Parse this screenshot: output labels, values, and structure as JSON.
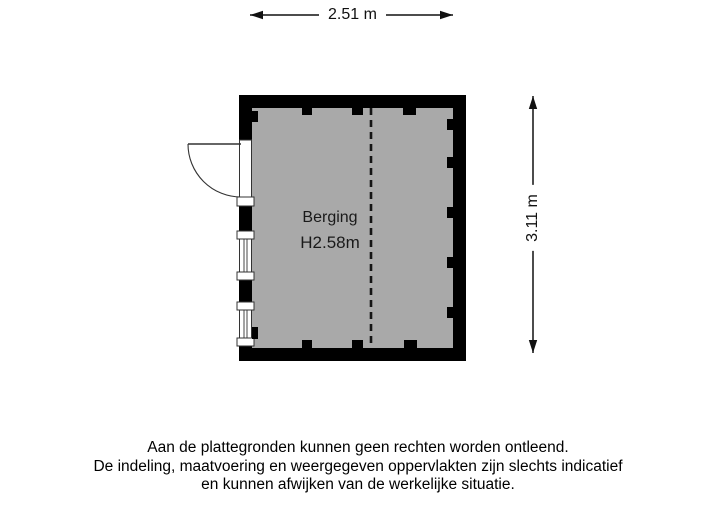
{
  "plan": {
    "room": {
      "name": "Berging",
      "ceiling_height": "H2.58m"
    },
    "dimensions": {
      "width_label": "2.51 m",
      "height_label": "3.11 m"
    },
    "colors": {
      "wall": "#000000",
      "floor": "#a9a9a9",
      "line": "#1a1a1a",
      "background": "#ffffff"
    }
  },
  "disclaimer": {
    "lines": [
      "Aan de plattegronden kunnen geen rechten worden ontleend.",
      "De indeling, maatvoering en weergegeven oppervlakten zijn slechts indicatief",
      "en kunnen afwijken van de werkelijke situatie."
    ]
  }
}
